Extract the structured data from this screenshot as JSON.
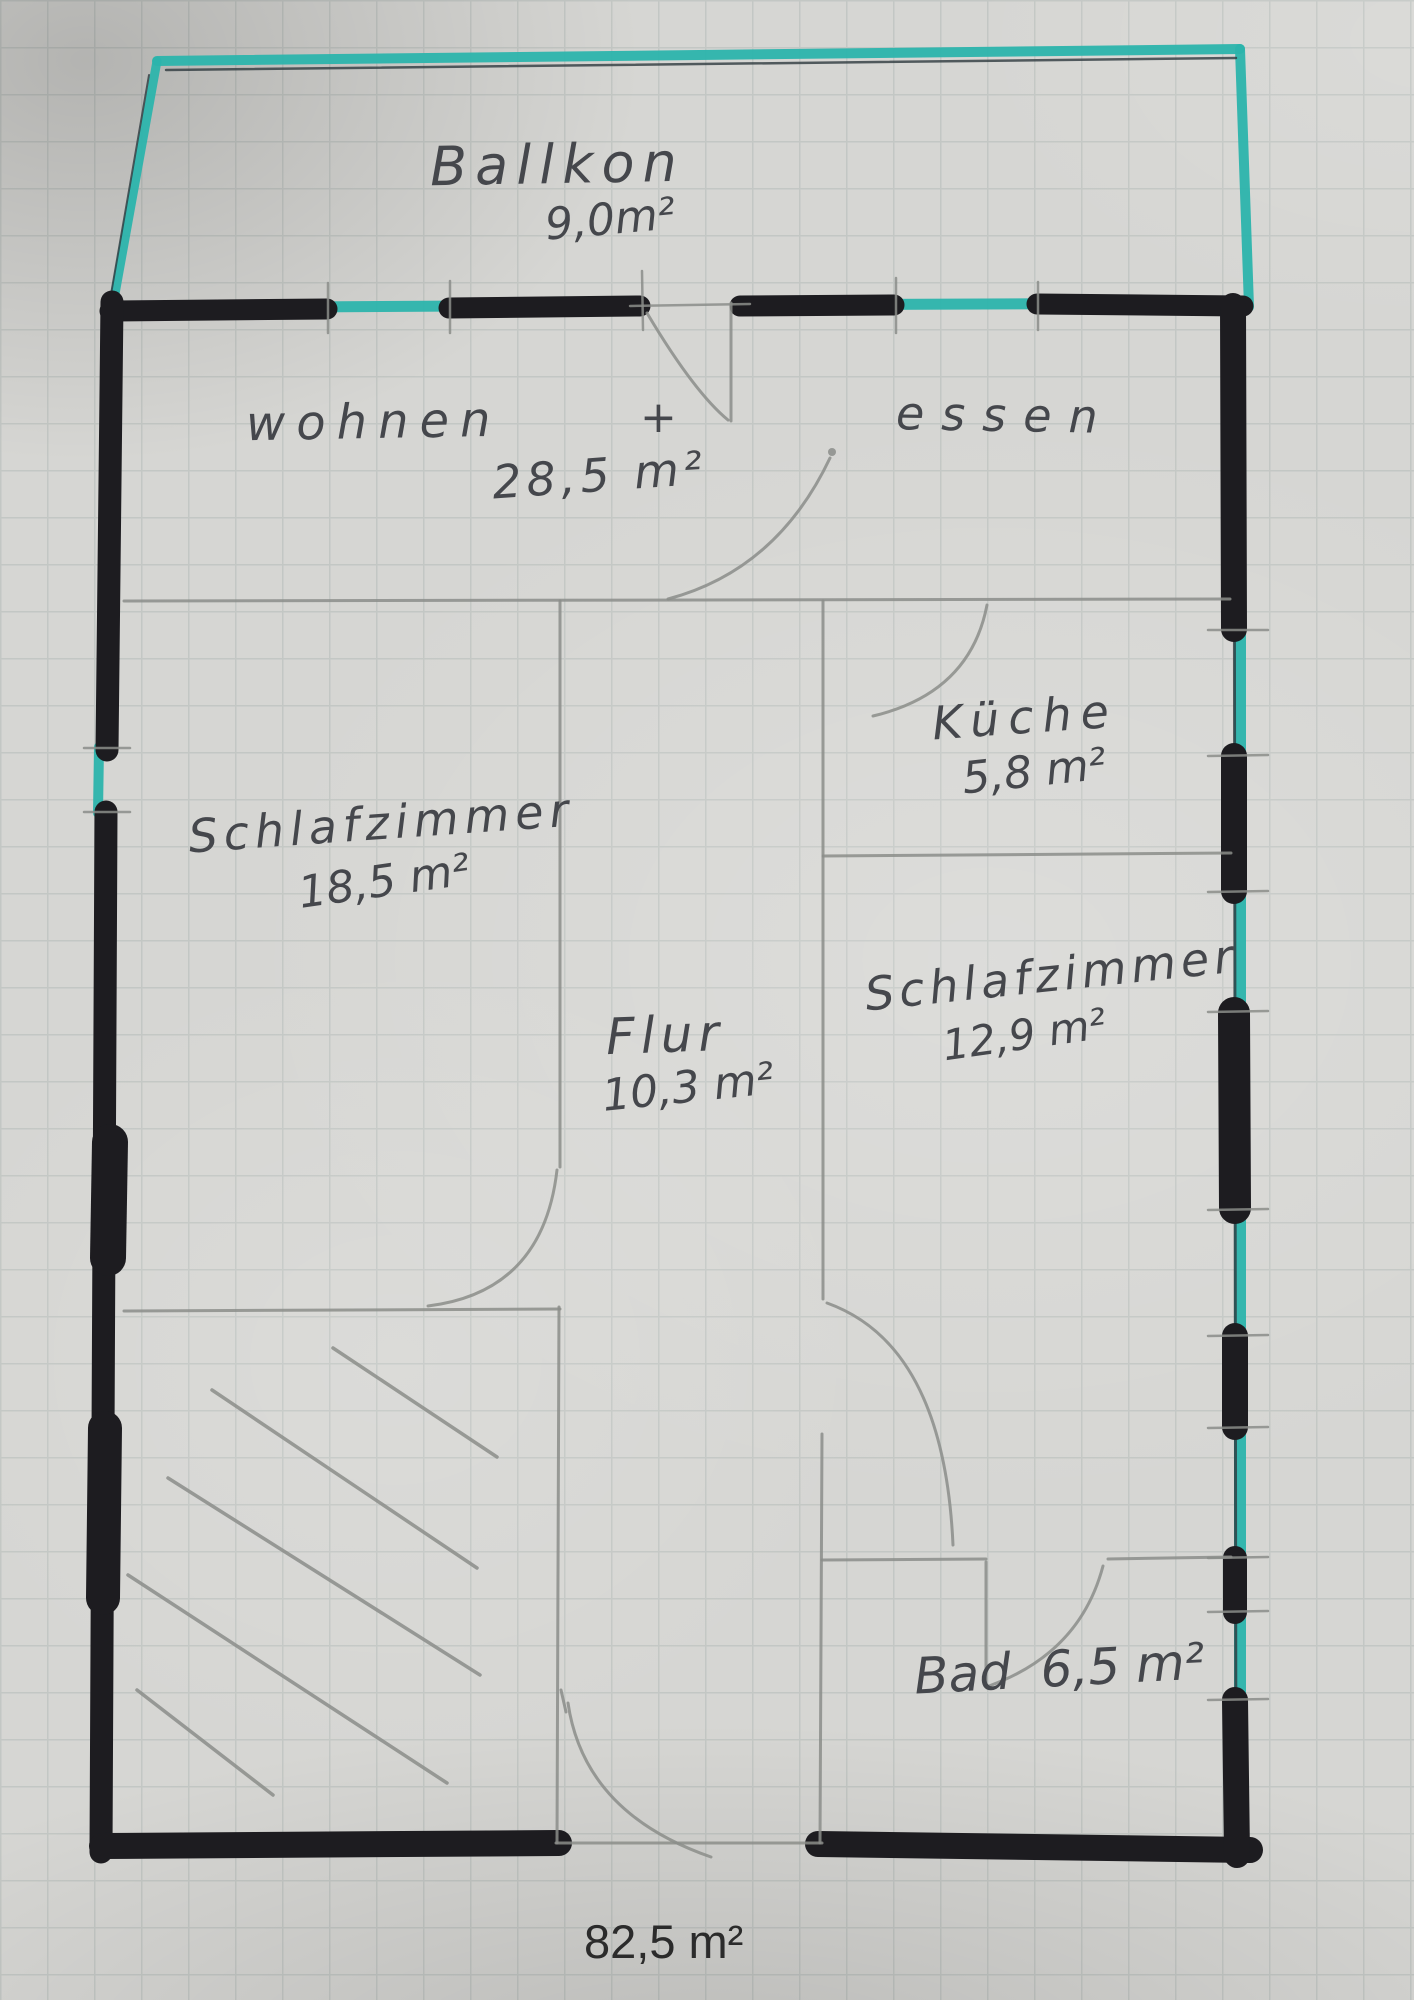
{
  "colors": {
    "paper": "#d6d6d3",
    "grid-line": "#c3c7c4",
    "marker-black": "#1d1c20",
    "highlight-teal": "#2cb4ac",
    "pencil": "#8b8d89",
    "ink": "#45474c",
    "typed": "#2b2b2b"
  },
  "rooms": {
    "balcony": {
      "label": "Ballkon",
      "area": "9,0m²"
    },
    "living_dining": {
      "label_left": "wohnen",
      "separator": "+",
      "label_right": "essen",
      "area": "28,5 m²"
    },
    "kitchen": {
      "label": "Küche",
      "area": "5,8 m²"
    },
    "bedroom_left": {
      "label": "Schlafzimmer",
      "area": "18,5 m²"
    },
    "hallway": {
      "label": "Flur",
      "area": "10,3 m²"
    },
    "bedroom_right": {
      "label": "Schlafzimmer",
      "area": "12,9 m²"
    },
    "bathroom": {
      "label": "Bad",
      "area": "6,5 m²"
    }
  },
  "total": {
    "area": "82,5 m²"
  }
}
